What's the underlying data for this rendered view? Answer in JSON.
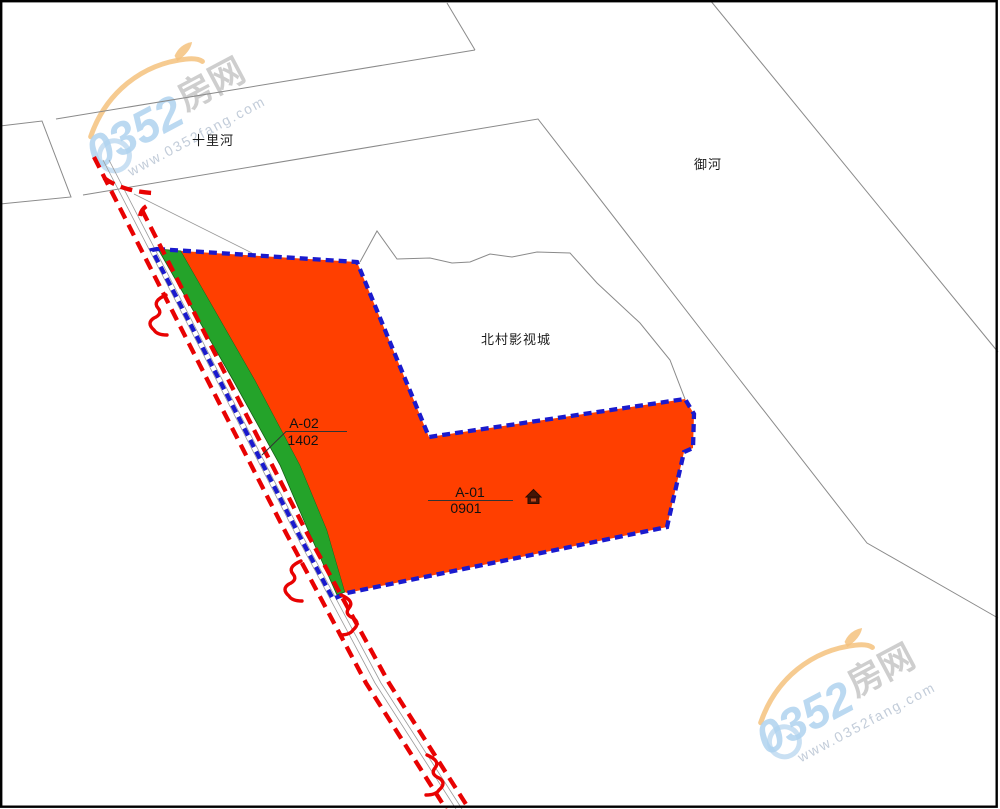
{
  "map_labels": {
    "shilihe": "十里河",
    "yuhe": "御河",
    "beicun": "北村影视城"
  },
  "parcels": {
    "a02": {
      "code": "A-02",
      "number": "1402"
    },
    "a01": {
      "code": "A-01",
      "number": "0901"
    }
  },
  "icons": {
    "a01_symbol": "house-icon"
  },
  "colors": {
    "parcel_fill_orange": "#FF3F00",
    "greenbelt_fill": "#24A32A",
    "boundary_blue": "#1A1ACD",
    "road_red_line": "#E80202",
    "cadastre_gray": "#8a8a8a",
    "watermark_blue": "#AFD2EE",
    "watermark_orange": "#F4C27E"
  },
  "watermark": {
    "brand_number": "0352",
    "brand_suffix": "房网",
    "url": "www.0352fang.com"
  }
}
